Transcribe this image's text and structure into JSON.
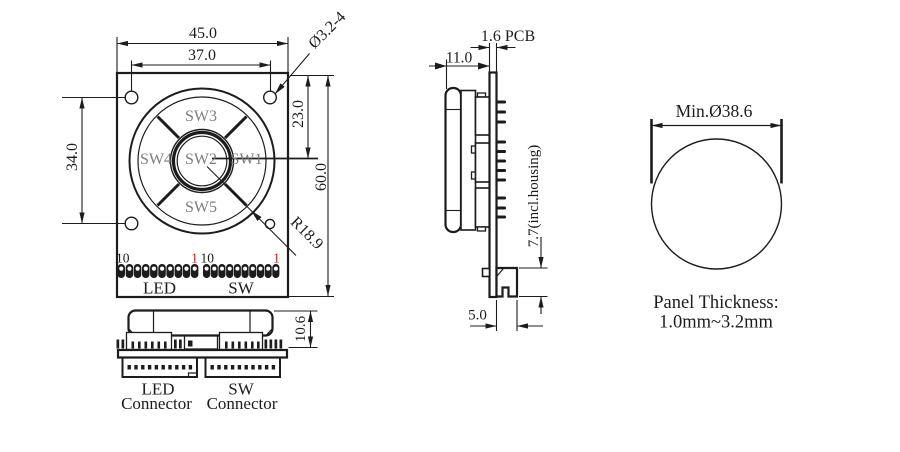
{
  "front_view": {
    "dim_overall_width": "45.0",
    "dim_hole_spacing_width": "37.0",
    "dim_mounting_holes": "Ø3.2-4",
    "dim_hole_spacing_height": "34.0",
    "dim_center_from_top": "23.0",
    "dim_overall_height": "60.0",
    "dim_keycap_radius": "R18.9",
    "switch_labels": {
      "sw1": "SW1",
      "sw2": "SW2",
      "sw3": "SW3",
      "sw4": "SW4",
      "sw5": "SW5"
    },
    "led_header": {
      "pin10": "10",
      "pin1": "1",
      "label": "LED"
    },
    "sw_header": {
      "pin10": "10",
      "pin1": "1",
      "label": "SW"
    }
  },
  "bottom_view": {
    "dim_height_above_pcb": "10.6",
    "led_connector_label": {
      "line1": "LED",
      "line2": "Connector"
    },
    "sw_connector_label": {
      "line1": "SW",
      "line2": "Connector"
    }
  },
  "side_view": {
    "dim_pcb_thickness": "1.6 PCB",
    "dim_keycap_depth": "11.0",
    "dim_rear_protrusion": "7.7(incl.housing)",
    "dim_connector_protrusion": "5.0"
  },
  "panel_cutout": {
    "dim_min_diameter": "Min.Ø38.6",
    "note_line1": "Panel Thickness:",
    "note_line2": "1.0mm~3.2mm"
  },
  "colors": {
    "line": "#1c1c1c",
    "label": "#7d7d7d",
    "red": "#cf1f1f",
    "bg": "#ffffff"
  }
}
